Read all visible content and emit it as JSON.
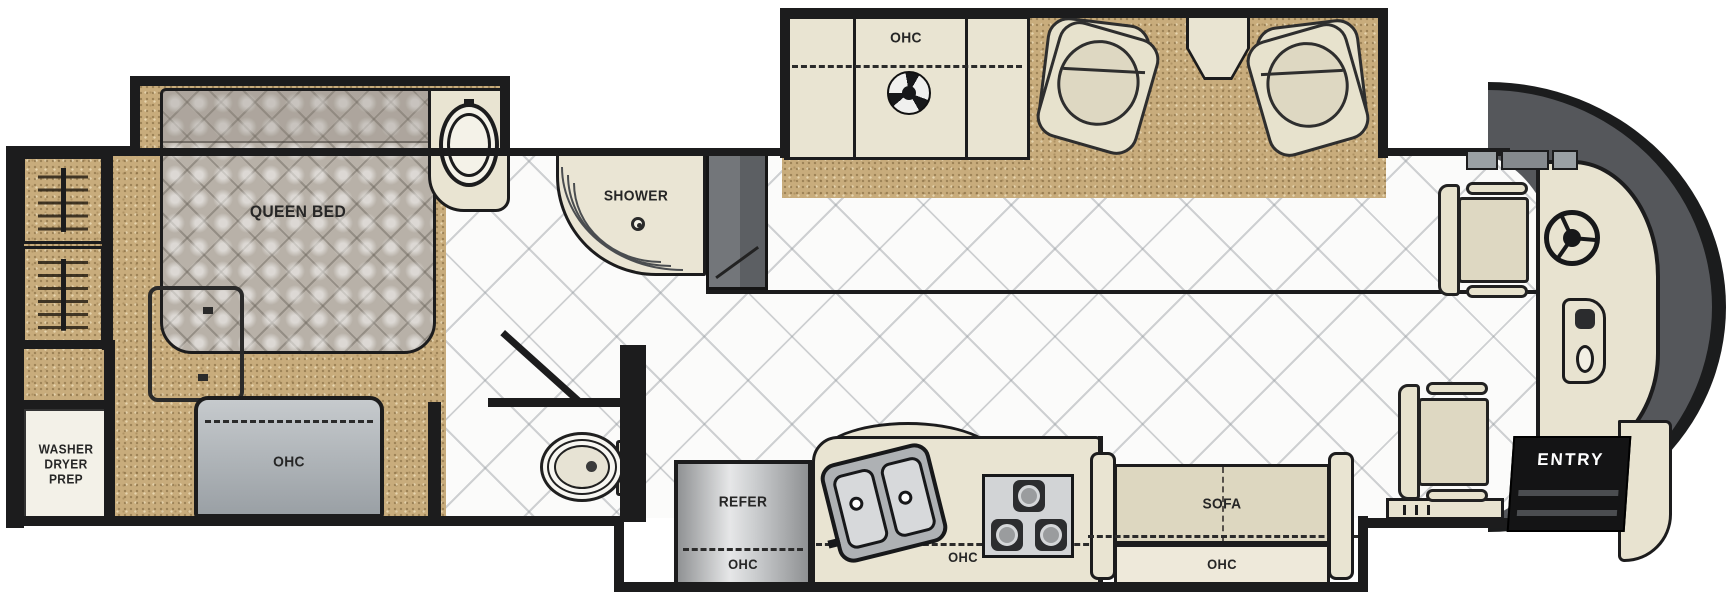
{
  "floorplan": {
    "type": "RV motorhome floor plan diagram",
    "labels": {
      "washer_dryer_prep": "WASHER\nDRYER\nPREP",
      "queen_bed": "QUEEN BED",
      "shower": "SHOWER",
      "ohc": "OHC",
      "refer": "REFER",
      "sofa": "SOFA",
      "entry": "ENTRY"
    },
    "colors": {
      "wall": "#1c1c1d",
      "carpet": "#c8ac7c",
      "tile_floor": "#fbfbfa",
      "cabinet_beige": "#e9e4d2",
      "mattress_gray": "#b8b1a8",
      "cabinet_gray": "#a8adb2",
      "front_cap_gray": "#55575b",
      "entry_background": "#141415",
      "entry_text": "#ffffff"
    }
  }
}
